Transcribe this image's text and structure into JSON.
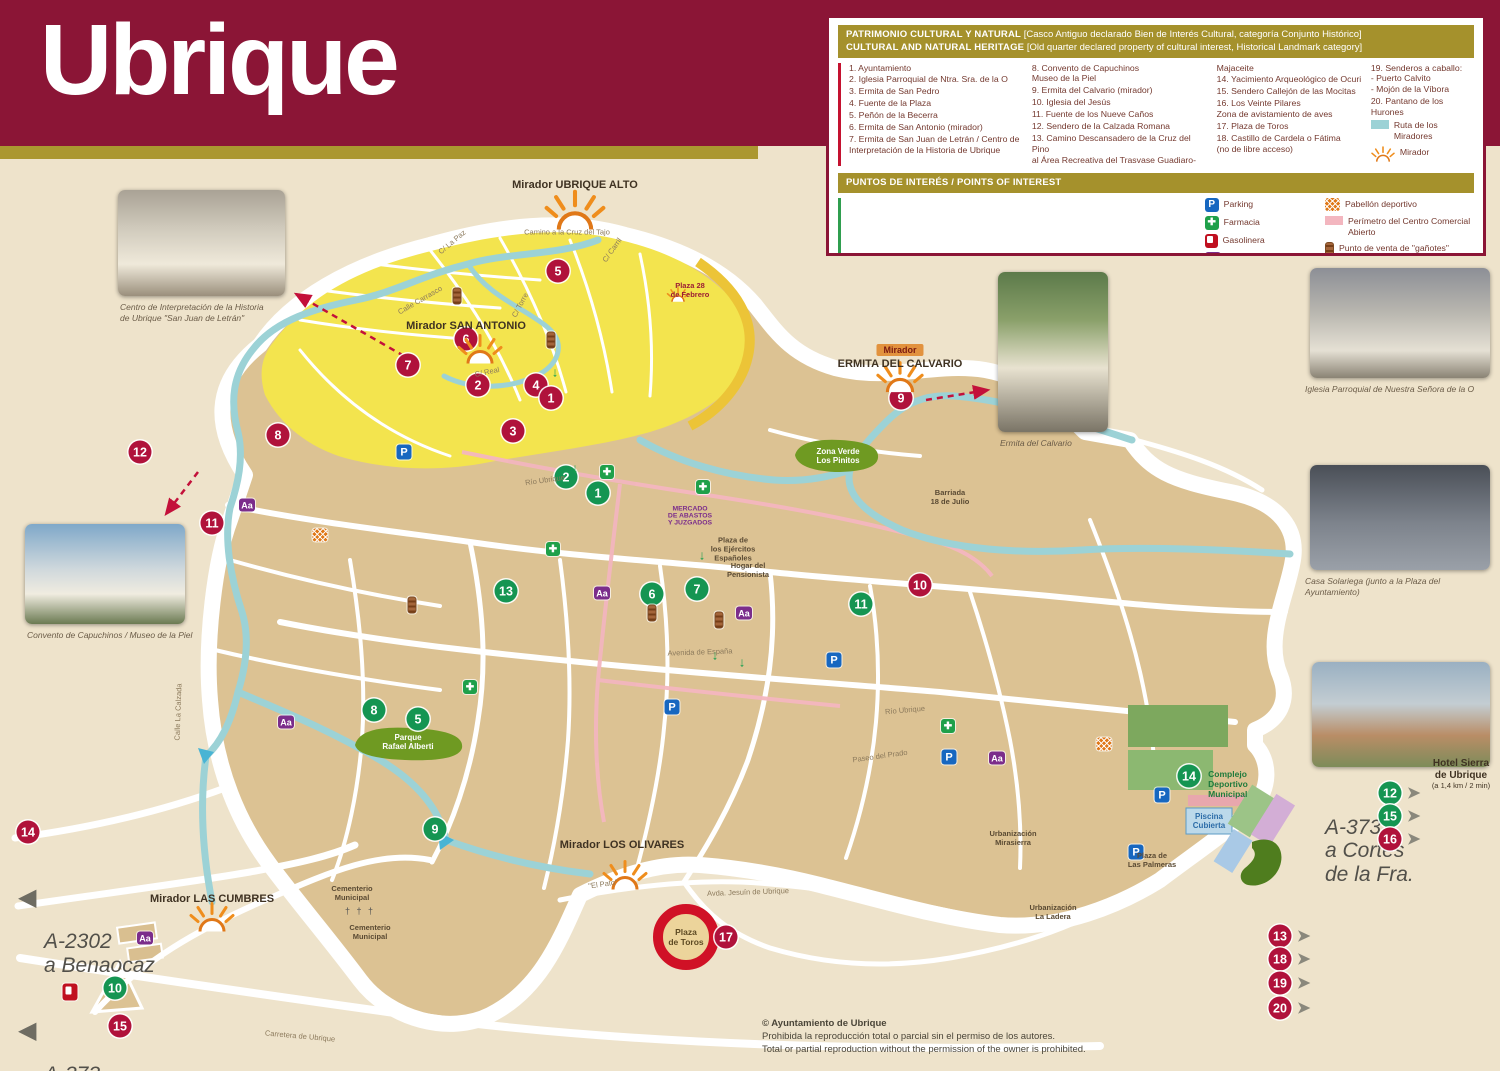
{
  "title": "Ubrique",
  "colors": {
    "header_maroon": "#8b1536",
    "gold": "#a5912c",
    "bg_beige": "#eee3cb",
    "red_marker": "#b0123b",
    "green_marker": "#159552",
    "ruta_teal": "#9cd2d6",
    "perimetro_pink": "#f3b6bf",
    "old_quarter_yellow": "#f3e44e",
    "town_tan": "#dcc293"
  },
  "heritage_legend": {
    "title_es": "PATRIMONIO CULTURAL Y NATURAL",
    "note_es": "[Casco Antiguo declarado Bien de Interés Cultural, categoría Conjunto Histórico]",
    "title_en": "CULTURAL AND NATURAL HERITAGE",
    "note_en": "[Old quarter declared property of cultural interest, Historical Landmark category]",
    "col1": [
      "1. Ayuntamiento",
      "2. Iglesia Parroquial de Ntra. Sra. de la O",
      "3. Ermita de San Pedro",
      "4. Fuente de la Plaza",
      "5. Peñón de la Becerra",
      "6. Ermita de San Antonio (mirador)",
      "7. Ermita de San Juan de Letrán / Centro de\nInterpretación de la Historia de Ubrique"
    ],
    "col2": [
      "8. Convento de Capuchinos\n    Museo de la Piel",
      "9. Ermita del Calvario (mirador)",
      "10. Iglesia del Jesús",
      "11. Fuente de los Nueve Caños",
      "12. Sendero de la Calzada Romana",
      "13. Camino Descansadero de la Cruz del Pino\nal Área Recreativa del Trasvase Guadiaro-"
    ],
    "col3": [
      "Majaceite",
      "14. Yacimiento Arqueológico de Ocuri",
      "15. Sendero Callejón de las Mocitas",
      "16. Los Veinte Pilares\n      Zona de avistamiento de aves",
      "17. Plaza de Toros",
      "18. Castillo de Cardela o Fátima\n      (no de libre acceso)"
    ],
    "col4": [
      "19. Senderos a caballo:\n      - Puerto Calvito\n      - Mojón de la Víbora",
      "20. Pantano de los Hurones"
    ],
    "extras": [
      {
        "type": "ruta",
        "label": "Ruta de los Miradores"
      },
      {
        "type": "mirador",
        "label": "Mirador"
      }
    ]
  },
  "poi_legend": {
    "title": "PUNTOS DE INTERÉS / POINTS OF INTEREST",
    "col1": [
      "1. Oficina de Turismo",
      "2. Policía Local",
      "3. Juzgados",
      "4. Punto de Información Turística",
      "5. Taxis",
      "6. Correos y Telégrafos",
      "7. Centro de Salud",
      "8. Parada de Bus"
    ],
    "col2": [
      "9. Guardia Civil",
      "10. Bomberos",
      "11. Biblioteca\n      Centro Guadalinfo",
      "12. Hotel Sierra de Ubrique",
      "13. El Laurel de Miguel",
      "14. Complejo Deportivo Municipal",
      "15. Centro Tecnológico de la Piel"
    ],
    "icons1": [
      {
        "type": "parking",
        "glyph": "P",
        "label": "Parking"
      },
      {
        "type": "farmacia",
        "glyph": "✚",
        "label": "Farmacia"
      },
      {
        "type": "gasolinera",
        "glyph": "",
        "label": "Gasolinera"
      },
      {
        "type": "ceip",
        "glyph": "Aa",
        "label": "CEIP/IES"
      }
    ],
    "icons2": [
      {
        "type": "pabellon",
        "glyph": "",
        "label": "Pabellón deportivo"
      },
      {
        "type": "perimetro",
        "glyph": "",
        "label": "Perímetro del Centro Comercial\nAbierto"
      },
      {
        "type": "ganote",
        "glyph": "",
        "label": "Punto de venta de \"gañotes\""
      }
    ]
  },
  "photos": {
    "centro": {
      "caption": "Centro de Interpretación de la Historia\nde Ubrique \"San Juan de Letrán\""
    },
    "convento": {
      "caption": "Convento de Capuchinos / Museo de la Piel"
    },
    "ermita": {
      "caption": "Ermita del Calvario"
    },
    "iglesia": {
      "caption": "Iglesia Parroquial de Nuestra Señora de la O"
    },
    "casa": {
      "caption": "Casa Solariega (junto a la Plaza del Ayuntamiento)"
    }
  },
  "signs": {
    "benaocaz": "A-2302\na Benaocaz",
    "bosque": "A-373\na El Bosque",
    "cortes": "A-373\na Cortes\nde la Fra.",
    "hotel_title": "Hotel Sierra\nde Ubrique",
    "hotel_sub": "(a 1,4 km / 2 min)"
  },
  "copyright": {
    "l1": "© Ayuntamiento de Ubrique",
    "l2": "Prohibida la reproducción total o parcial sin el permiso de los autores.",
    "l3": "Total or partial reproduction without the permission of the owner is prohibited."
  },
  "map": {
    "red_markers": [
      {
        "n": "5",
        "x": 558,
        "y": 271
      },
      {
        "n": "6",
        "x": 466,
        "y": 339
      },
      {
        "n": "7",
        "x": 408,
        "y": 365
      },
      {
        "n": "2",
        "x": 478,
        "y": 385
      },
      {
        "n": "4",
        "x": 536,
        "y": 385
      },
      {
        "n": "1",
        "x": 551,
        "y": 398
      },
      {
        "n": "3",
        "x": 513,
        "y": 431
      },
      {
        "n": "8",
        "x": 278,
        "y": 435
      },
      {
        "n": "12",
        "x": 140,
        "y": 452
      },
      {
        "n": "11",
        "x": 212,
        "y": 523
      },
      {
        "n": "9",
        "x": 901,
        "y": 398
      },
      {
        "n": "10",
        "x": 920,
        "y": 585
      },
      {
        "n": "14",
        "x": 28,
        "y": 832
      },
      {
        "n": "15",
        "x": 120,
        "y": 1026
      },
      {
        "n": "17",
        "x": 726,
        "y": 937
      }
    ],
    "green_markers": [
      {
        "n": "2",
        "x": 566,
        "y": 477
      },
      {
        "n": "1",
        "x": 598,
        "y": 493
      },
      {
        "n": "13",
        "x": 506,
        "y": 591
      },
      {
        "n": "6",
        "x": 652,
        "y": 594
      },
      {
        "n": "7",
        "x": 697,
        "y": 589
      },
      {
        "n": "11",
        "x": 861,
        "y": 604
      },
      {
        "n": "8",
        "x": 374,
        "y": 710
      },
      {
        "n": "5",
        "x": 418,
        "y": 719
      },
      {
        "n": "9",
        "x": 435,
        "y": 829
      },
      {
        "n": "14",
        "x": 1189,
        "y": 776
      },
      {
        "n": "10",
        "x": 115,
        "y": 988
      }
    ],
    "arrow_markers": [
      {
        "n": "12",
        "c": "green",
        "x": 1390,
        "y": 793
      },
      {
        "n": "15",
        "c": "green",
        "x": 1390,
        "y": 816
      },
      {
        "n": "16",
        "c": "red",
        "x": 1390,
        "y": 839
      },
      {
        "n": "13",
        "c": "red",
        "x": 1280,
        "y": 936
      },
      {
        "n": "18",
        "c": "red",
        "x": 1280,
        "y": 959
      },
      {
        "n": "19",
        "c": "red",
        "x": 1280,
        "y": 983
      },
      {
        "n": "20",
        "c": "red",
        "x": 1280,
        "y": 1008
      }
    ],
    "icons": [
      {
        "type": "parking",
        "x": 404,
        "y": 452
      },
      {
        "type": "parking",
        "x": 834,
        "y": 660
      },
      {
        "type": "parking",
        "x": 672,
        "y": 707
      },
      {
        "type": "parking",
        "x": 949,
        "y": 757
      },
      {
        "type": "parking",
        "x": 1162,
        "y": 795
      },
      {
        "type": "parking",
        "x": 1136,
        "y": 852
      },
      {
        "type": "farmacia",
        "x": 553,
        "y": 549
      },
      {
        "type": "farmacia",
        "x": 703,
        "y": 487
      },
      {
        "type": "farmacia",
        "x": 470,
        "y": 687
      },
      {
        "type": "farmacia",
        "x": 948,
        "y": 726
      },
      {
        "type": "farmacia",
        "x": 607,
        "y": 472
      },
      {
        "type": "ceip",
        "x": 247,
        "y": 505
      },
      {
        "type": "ceip",
        "x": 286,
        "y": 722
      },
      {
        "type": "ceip",
        "x": 602,
        "y": 593
      },
      {
        "type": "ceip",
        "x": 744,
        "y": 613
      },
      {
        "type": "ceip",
        "x": 997,
        "y": 758
      },
      {
        "type": "ceip",
        "x": 145,
        "y": 938
      },
      {
        "type": "pabellon",
        "x": 320,
        "y": 535
      },
      {
        "type": "pabellon",
        "x": 1104,
        "y": 744
      },
      {
        "type": "ganote",
        "x": 457,
        "y": 296
      },
      {
        "type": "ganote",
        "x": 551,
        "y": 340
      },
      {
        "type": "ganote",
        "x": 412,
        "y": 605
      },
      {
        "type": "ganote",
        "x": 719,
        "y": 620
      },
      {
        "type": "ganote",
        "x": 652,
        "y": 613
      },
      {
        "type": "gasolinera",
        "x": 70,
        "y": 992
      }
    ],
    "suns": [
      {
        "x": 575,
        "y": 214,
        "s": 1.35
      },
      {
        "x": 480,
        "y": 352,
        "s": 1
      },
      {
        "x": 900,
        "y": 380,
        "s": 1.05
      },
      {
        "x": 678,
        "y": 296,
        "s": 0.5
      },
      {
        "x": 625,
        "y": 878,
        "s": 1
      },
      {
        "x": 212,
        "y": 920,
        "s": 1
      }
    ],
    "labels": [
      {
        "t": "Mirador UBRIQUE ALTO",
        "x": 575,
        "y": 185,
        "cls": "mirador"
      },
      {
        "t": "Mirador SAN ANTONIO",
        "x": 466,
        "y": 326,
        "cls": "mirador"
      },
      {
        "t": "Mirador",
        "x": 900,
        "y": 350,
        "cls": "mirador-box"
      },
      {
        "t": "ERMITA DEL CALVARIO",
        "x": 900,
        "y": 364,
        "cls": "mirador"
      },
      {
        "t": "Mirador LOS OLIVARES",
        "x": 622,
        "y": 845,
        "cls": "mirador"
      },
      {
        "t": "Mirador LAS CUMBRES",
        "x": 212,
        "y": 899,
        "cls": "mirador"
      },
      {
        "t": "Plaza 28\nde Febrero",
        "x": 690,
        "y": 290,
        "cls": "tiny-red"
      },
      {
        "t": "Zona Verde\nLos Pinitos",
        "x": 838,
        "y": 456,
        "cls": "park"
      },
      {
        "t": "Parque\nRafael Alberti",
        "x": 408,
        "y": 742,
        "cls": "park"
      },
      {
        "t": "Plaza\nde Toros",
        "x": 686,
        "y": 937,
        "cls": "plaza-toros"
      },
      {
        "t": "Complejo\nDeportivo\nMunicipal",
        "x": 1228,
        "y": 784,
        "cls": "deportivo"
      },
      {
        "t": "Piscina\nCubierta",
        "x": 1209,
        "y": 821,
        "cls": "piscina"
      },
      {
        "t": "Plaza de\nLas Palmeras",
        "x": 1152,
        "y": 860,
        "cls": "small-dark"
      },
      {
        "t": "Urbanización\nMirasierra",
        "x": 1013,
        "y": 838,
        "cls": "small-dark"
      },
      {
        "t": "Urbanización\nLa Ladera",
        "x": 1053,
        "y": 912,
        "cls": "small-dark"
      },
      {
        "t": "Barriada\n18 de Julio",
        "x": 950,
        "y": 497,
        "cls": "small-dark"
      },
      {
        "t": "Hogar del\nPensionista",
        "x": 748,
        "y": 570,
        "cls": "small-dark"
      },
      {
        "t": "Plaza de\nlos Ejércitos\nEspañoles",
        "x": 733,
        "y": 549,
        "cls": "small-dark"
      },
      {
        "t": "Cementerio\nMunicipal",
        "x": 352,
        "y": 893,
        "cls": "small-dark"
      },
      {
        "t": "† † †",
        "x": 360,
        "y": 911,
        "cls": "crosses"
      },
      {
        "t": "Cementerio\nMunicipal",
        "x": 370,
        "y": 932,
        "cls": "small-dark"
      },
      {
        "t": "MERCADO\nDE ABASTOS\nY JUZGADOS",
        "x": 690,
        "y": 516,
        "cls": "tiny-purple"
      },
      {
        "t": "Camino a la\nCruz del Tajo",
        "x": 567,
        "y": 232,
        "cls": "street"
      },
      {
        "t": "C/ La Paz",
        "x": 452,
        "y": 242,
        "cls": "street",
        "rot": -40
      },
      {
        "t": "C/ Carril",
        "x": 612,
        "y": 250,
        "cls": "street",
        "rot": -55
      },
      {
        "t": "Calle  Carrasco",
        "x": 420,
        "y": 300,
        "cls": "street",
        "rot": -30
      },
      {
        "t": "C/ Torre",
        "x": 520,
        "y": 305,
        "cls": "street",
        "rot": -62
      },
      {
        "t": "C/ Real",
        "x": 487,
        "y": 372,
        "cls": "street",
        "rot": -12
      },
      {
        "t": "Avenida  de  España",
        "x": 700,
        "y": 652,
        "cls": "street",
        "rot": -2
      },
      {
        "t": "Paseo  del  Prado",
        "x": 880,
        "y": 756,
        "cls": "street",
        "rot": -8
      },
      {
        "t": "Río Ubrique",
        "x": 905,
        "y": 710,
        "cls": "street",
        "rot": -5
      },
      {
        "t": "Río Ubrique",
        "x": 545,
        "y": 480,
        "cls": "street",
        "rot": -8
      },
      {
        "t": "Calle La Calzada",
        "x": 178,
        "y": 712,
        "cls": "street",
        "rot": -88
      },
      {
        "t": "\"El Pato\"",
        "x": 603,
        "y": 884,
        "cls": "street",
        "rot": -8
      },
      {
        "t": "Avda.   Jesuín   de   Ubrique",
        "x": 748,
        "y": 892,
        "cls": "street",
        "rot": -2
      },
      {
        "t": "Carretera      de      Ubrique",
        "x": 300,
        "y": 1036,
        "cls": "street",
        "rot": 5
      },
      {
        "t": "↓",
        "x": 555,
        "y": 372,
        "cls": "green-arrow"
      },
      {
        "t": "↓",
        "x": 575,
        "y": 468,
        "cls": "green-arrow"
      },
      {
        "t": "↓",
        "x": 702,
        "y": 555,
        "cls": "green-arrow"
      },
      {
        "t": "↓",
        "x": 715,
        "y": 655,
        "cls": "green-arrow"
      },
      {
        "t": "↓",
        "x": 742,
        "y": 662,
        "cls": "green-arrow"
      }
    ]
  }
}
